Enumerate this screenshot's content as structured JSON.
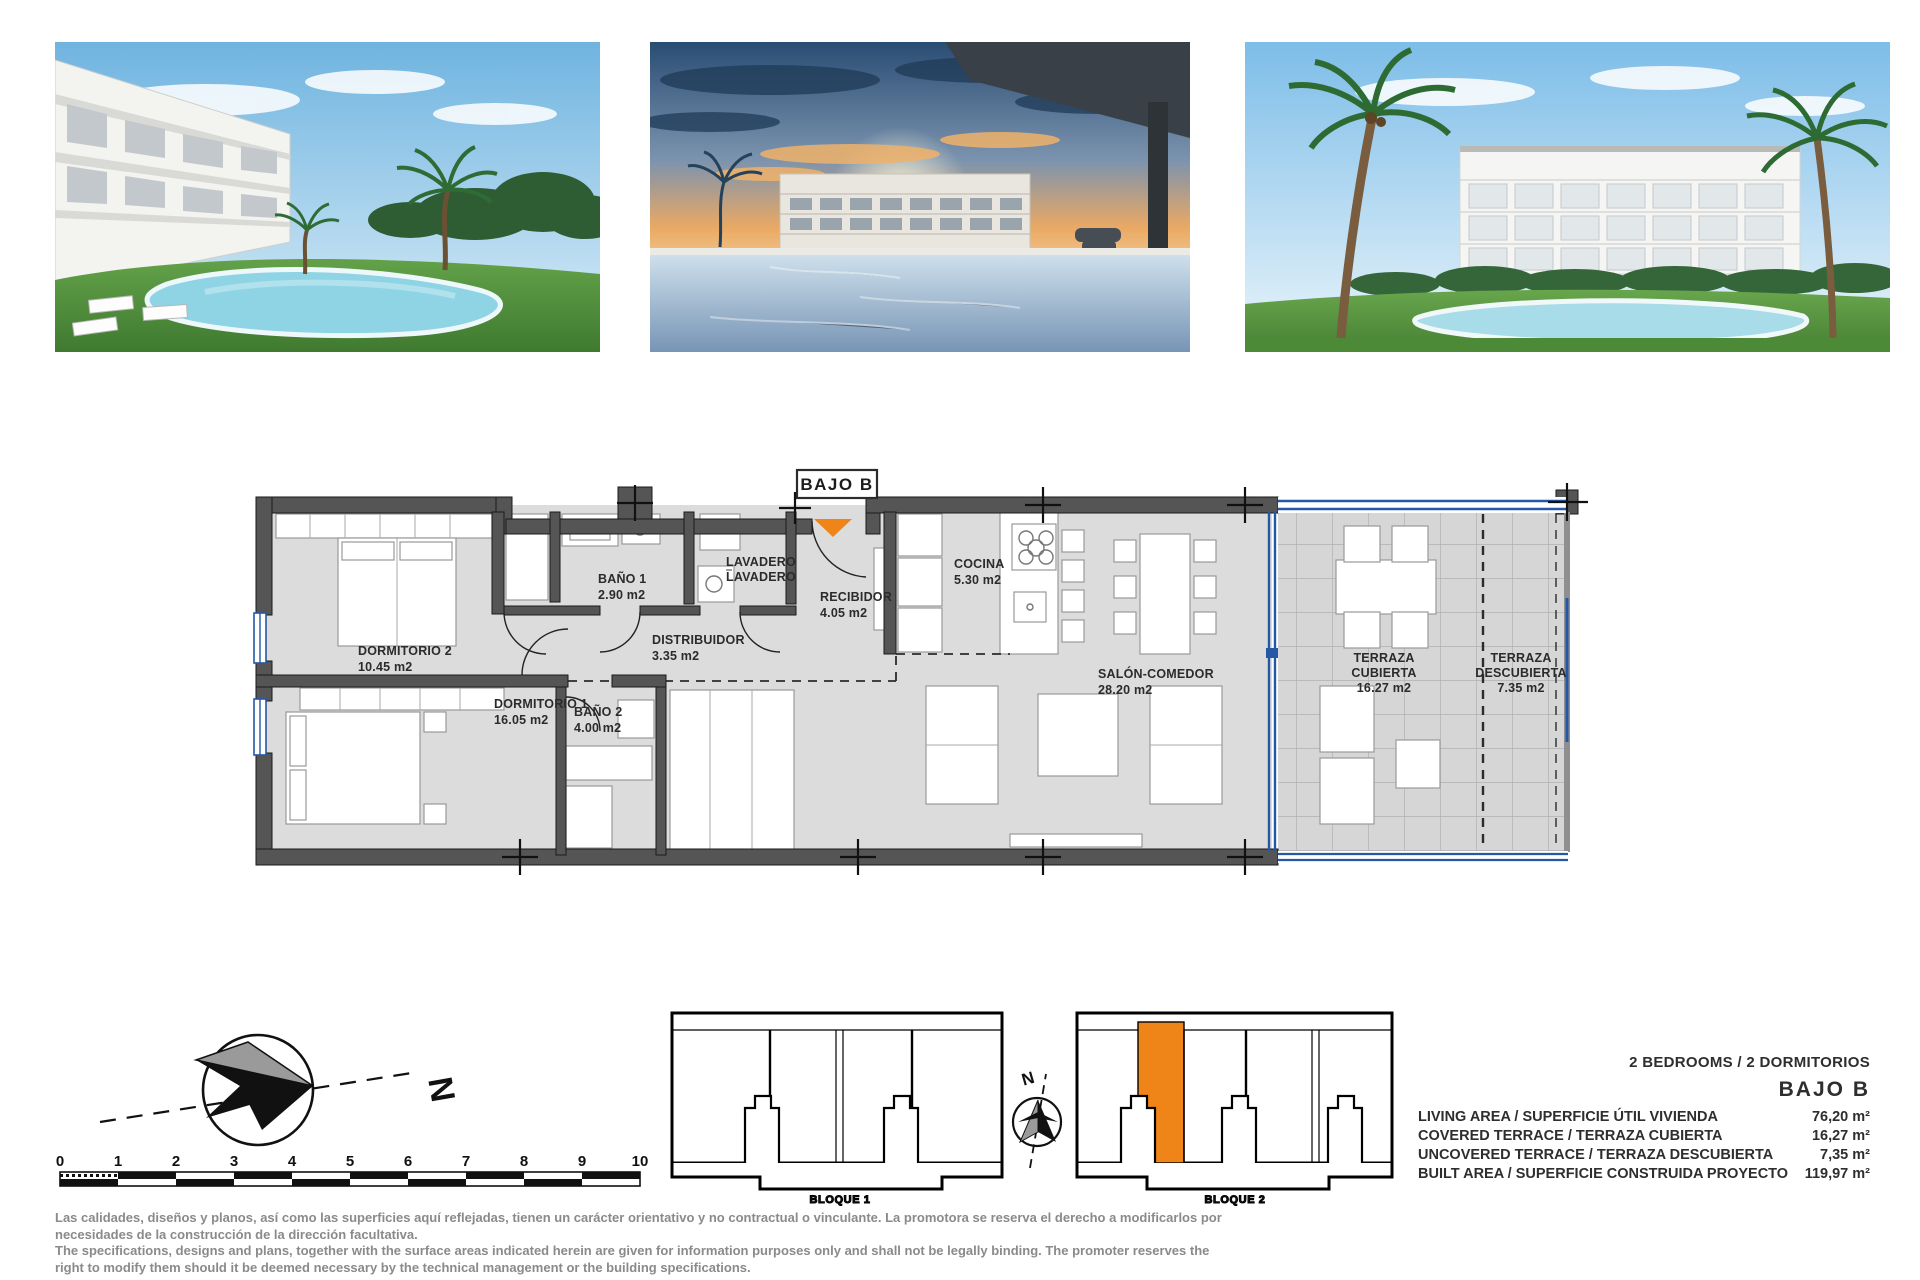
{
  "photos": [
    {
      "name": "exterior-pool-garden-render"
    },
    {
      "name": "sunset-pool-terrace-render"
    },
    {
      "name": "building-with-pool-render"
    }
  ],
  "floor_plan": {
    "unit_label": "BAJO B",
    "rooms": {
      "dormitorio2": {
        "name": "DORMITORIO 2",
        "area": "10.45 m2"
      },
      "bano1": {
        "name": "BAÑO 1",
        "area": "2.90 m2"
      },
      "lavadero": {
        "line1": "LAVADERO",
        "line2": "LAVADERO"
      },
      "recibidor": {
        "name": "RECIBIDOR",
        "area": "4.05 m2"
      },
      "distribuidor": {
        "name": "DISTRIBUIDOR",
        "area": "3.35 m2"
      },
      "dormitorio1": {
        "name": "DORMITORIO 1",
        "area": "16.05 m2"
      },
      "bano2": {
        "name": "BAÑO 2",
        "area": "4.00 m2"
      },
      "cocina": {
        "name": "COCINA",
        "area": "5.30 m2"
      },
      "salon": {
        "name": "SALÓN-COMEDOR",
        "area": "28.20 m2"
      },
      "terraza_cubierta": {
        "line1": "TERRAZA",
        "line2": "CUBIERTA",
        "area": "16.27 m2"
      },
      "terraza_descubierta": {
        "line1": "TERRAZA",
        "line2": "DESCUBIERTA",
        "area": "7.35 m2"
      }
    }
  },
  "site_plan": {
    "north_main": "N",
    "north_small": "N",
    "bloque1_label": "BLOQUE 1",
    "bloque2_label": "BLOQUE 2"
  },
  "scale_bar": {
    "ticks": [
      "0",
      "1",
      "2",
      "3",
      "4",
      "5",
      "6",
      "7",
      "8",
      "9",
      "10"
    ]
  },
  "summary": {
    "bedrooms_line": "2 BEDROOMS / 2 DORMITORIOS",
    "unit_name": "BAJO B",
    "rows": [
      {
        "label": "LIVING AREA / SUPERFICIE ÚTIL VIVIENDA",
        "value": "76,20 m²"
      },
      {
        "label": "COVERED TERRACE / TERRAZA CUBIERTA",
        "value": "16,27 m²"
      },
      {
        "label": "UNCOVERED TERRACE / TERRAZA DESCUBIERTA",
        "value": "7,35 m²"
      },
      {
        "label": "BUILT AREA / SUPERFICIE CONSTRUIDA PROYECTO",
        "value": "119,97 m²"
      }
    ]
  },
  "disclaimer": {
    "es_line1": "Las calidades, diseños y planos, así como las superficies aquí reflejadas, tienen un carácter orientativo y no contractual o vinculante. La promotora se reserva el derecho a modificarlos por",
    "es_line2": "necesidades de la construcción de la dirección facultativa.",
    "en_line1": "The specifications, designs and plans, together with the surface areas indicated herein are given for information purposes only and shall not be legally binding. The promoter reserves the",
    "en_line2": "right to modify them should it be deemed necessary by the technical management or the building specifications."
  },
  "colors": {
    "accent_orange": "#EF8418",
    "glass_blue": "#2458A6",
    "wall_gray": "#555555"
  }
}
